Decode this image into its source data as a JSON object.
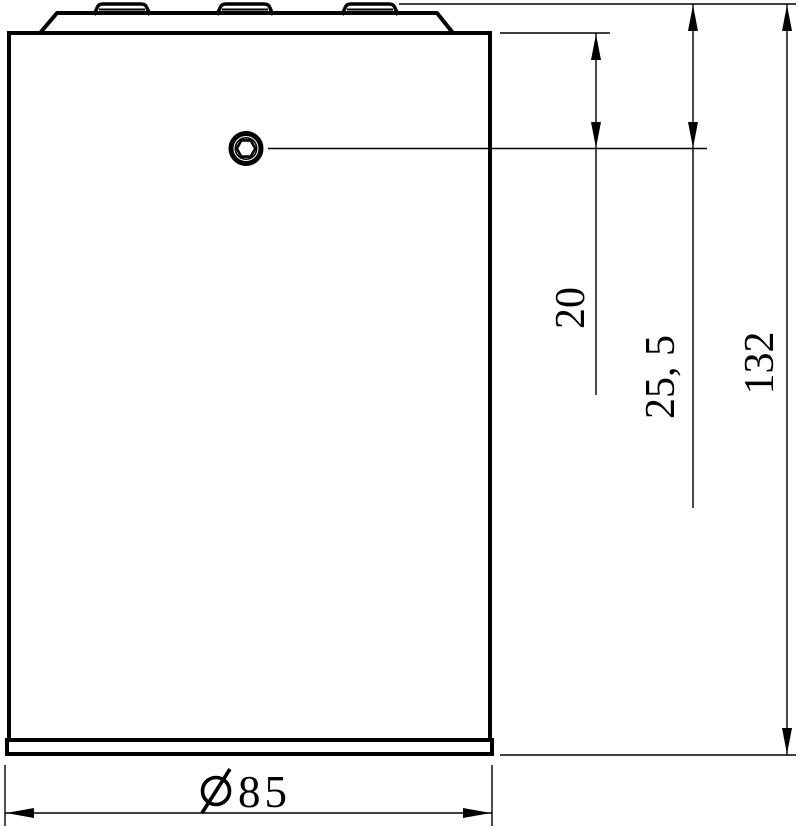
{
  "drawing": {
    "background_color": "#ffffff",
    "line_color": "#000000",
    "labels": {
      "screw_center_from_body_top": "20",
      "screw_center_from_part_top": "25, 5",
      "overall_height": "132",
      "diameter_symbol": "Ø",
      "diameter_value": "85"
    }
  }
}
